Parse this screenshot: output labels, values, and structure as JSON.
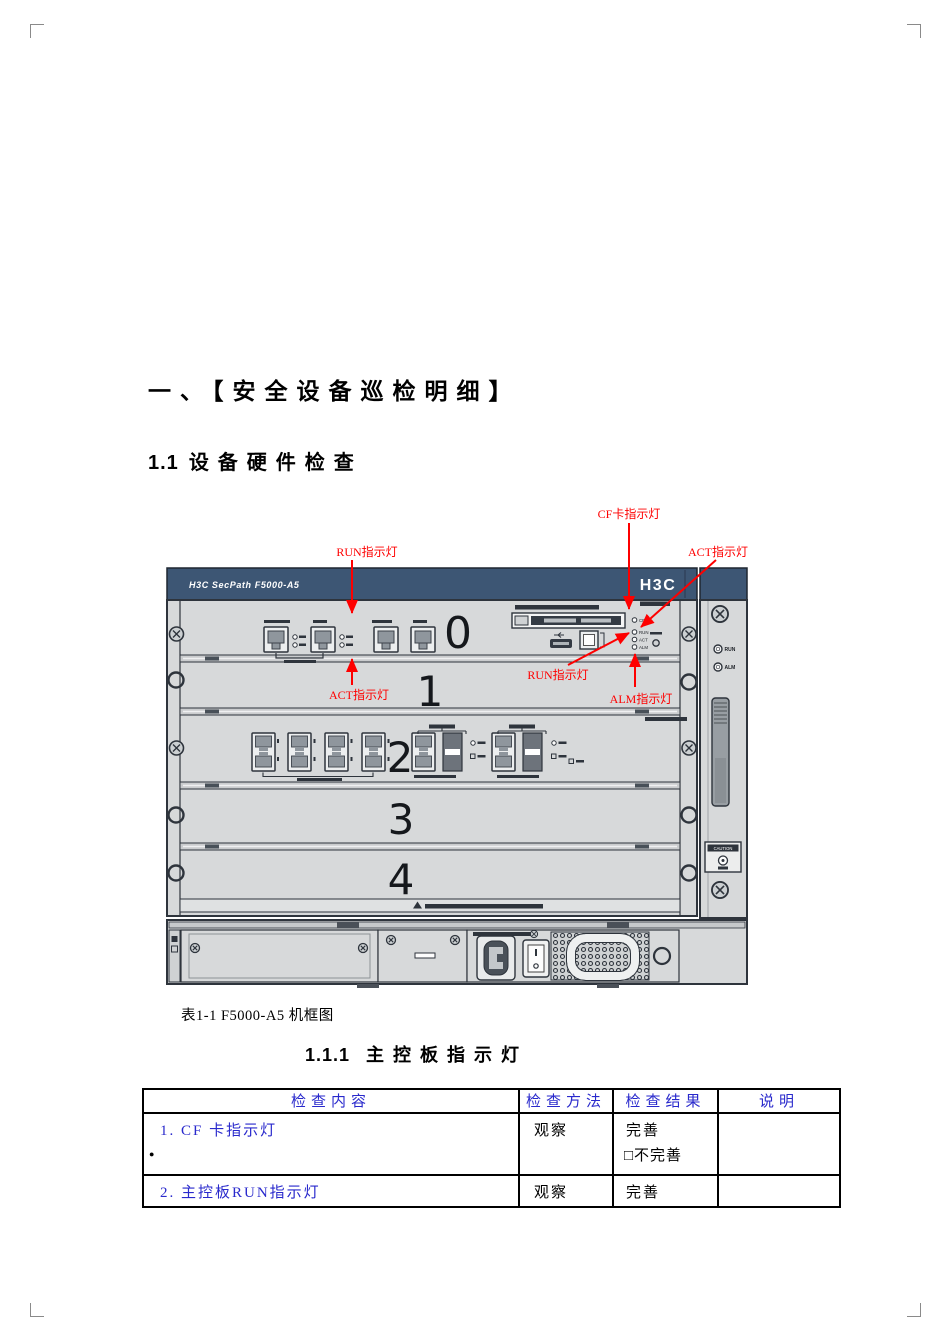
{
  "page": {
    "heading1": "一、【安全设备巡检明细】",
    "section_number": "1.1",
    "section_title": "设备硬件检查",
    "caption": "表1-1 F5000-A5 机框图",
    "sub_number": "1.1.1",
    "sub_title": "主控板指示灯"
  },
  "diagram": {
    "annotations": [
      {
        "id": "cf-card-led",
        "text": "CF卡指示灯"
      },
      {
        "id": "run-led-top",
        "text": "RUN指示灯"
      },
      {
        "id": "act-led-top",
        "text": "ACT指示灯"
      },
      {
        "id": "run-led-mid",
        "text": "RUN指示灯"
      },
      {
        "id": "act-led-bot",
        "text": "ACT指示灯"
      },
      {
        "id": "alm-led",
        "text": "ALM指示灯"
      }
    ],
    "annotation_color": "#fe0000",
    "chassis": {
      "brand_left": "H3C SecPath F5000-A5",
      "brand_right": "H3C",
      "slots": [
        "0",
        "1",
        "2",
        "3",
        "4"
      ],
      "mcu_leds": [
        "CF",
        "RUN",
        "ACT",
        "ALM"
      ],
      "panel_leds": [
        "RUN",
        "ALM"
      ],
      "caution": "CAUTION",
      "bar_color": "#3d5674",
      "body_color": "#d7d9da",
      "outline_color": "#2e343c"
    }
  },
  "table": {
    "header_color": "#2929cc",
    "headers": [
      "检查内容",
      "检查方法",
      "检查结果",
      "说明"
    ],
    "rows": [
      {
        "item": "1. CF  卡指示灯",
        "bullet": "●",
        "method": "观察",
        "result1": "完善",
        "result2": "□不完善",
        "note": ""
      },
      {
        "item": "2. 主控板RUN指示灯",
        "method": "观察",
        "result1": "完善",
        "note": ""
      }
    ]
  }
}
